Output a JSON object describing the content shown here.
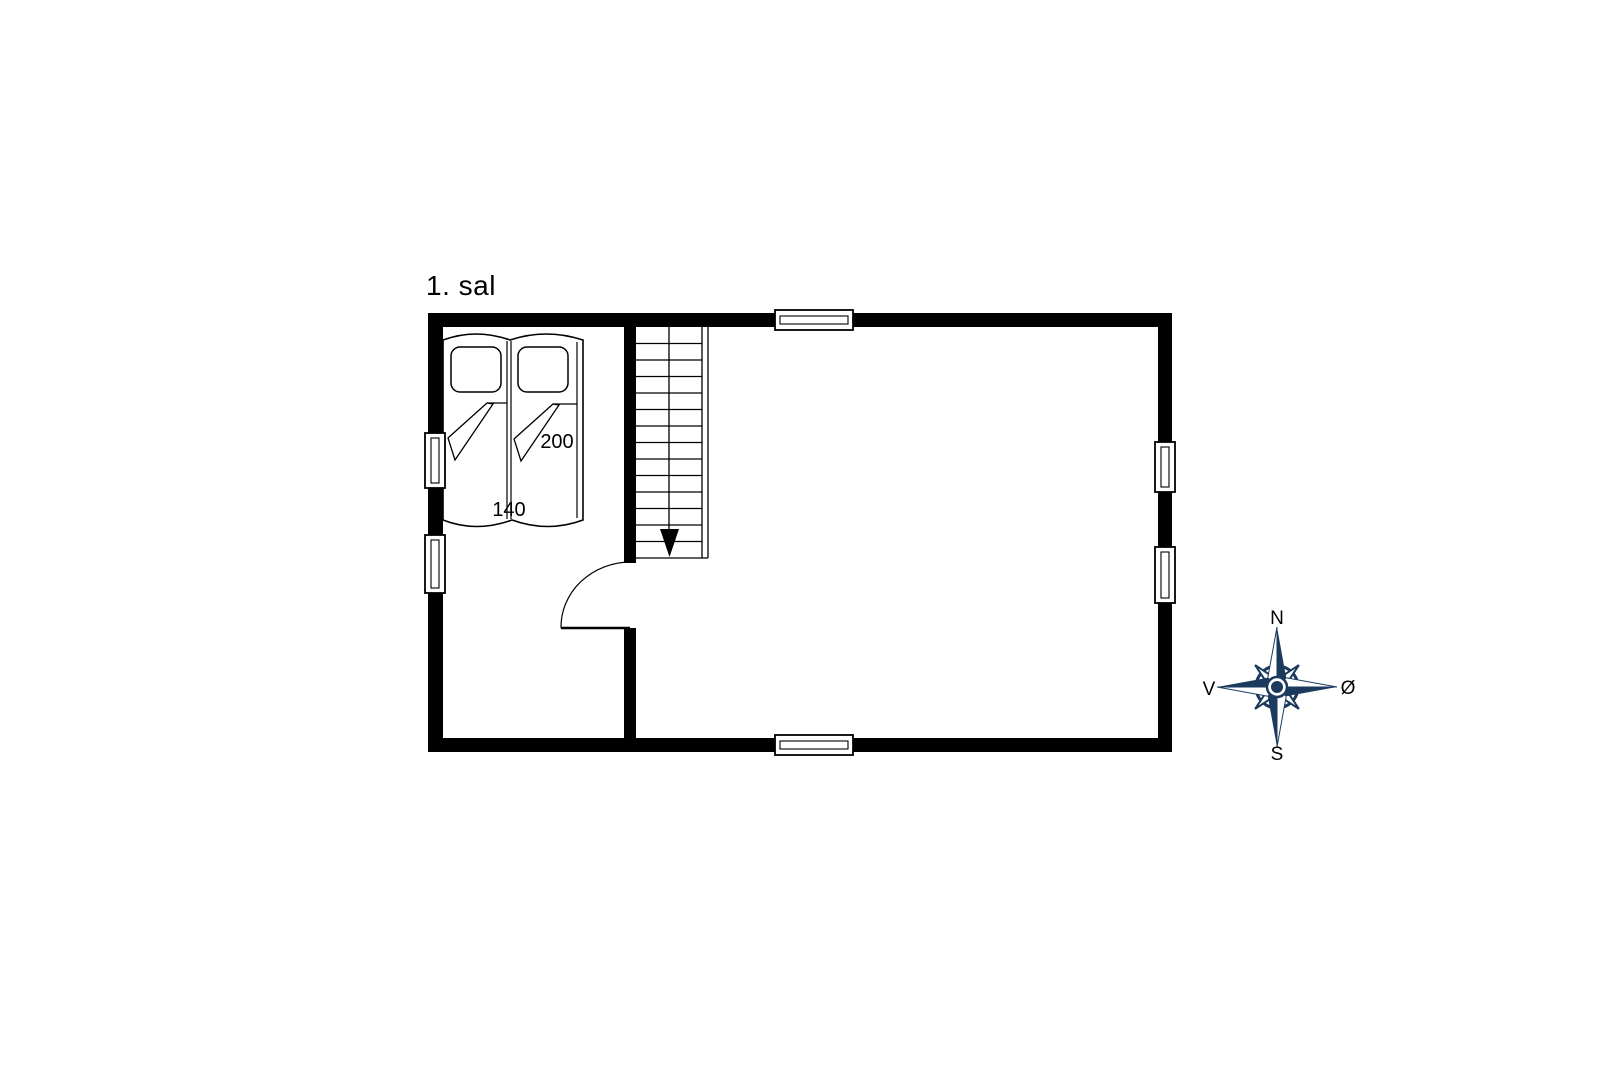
{
  "title": "1. sal",
  "bed": {
    "length_label": "200",
    "width_label": "140"
  },
  "compass": {
    "north": "N",
    "east": "Ø",
    "south": "S",
    "west": "V"
  },
  "icons": {
    "compass": "compass-rose",
    "stair_direction": "arrow-down"
  },
  "colors": {
    "wall": "#000000",
    "line": "#000000",
    "compass_navy": "#1c3a5e",
    "background": "#ffffff"
  }
}
